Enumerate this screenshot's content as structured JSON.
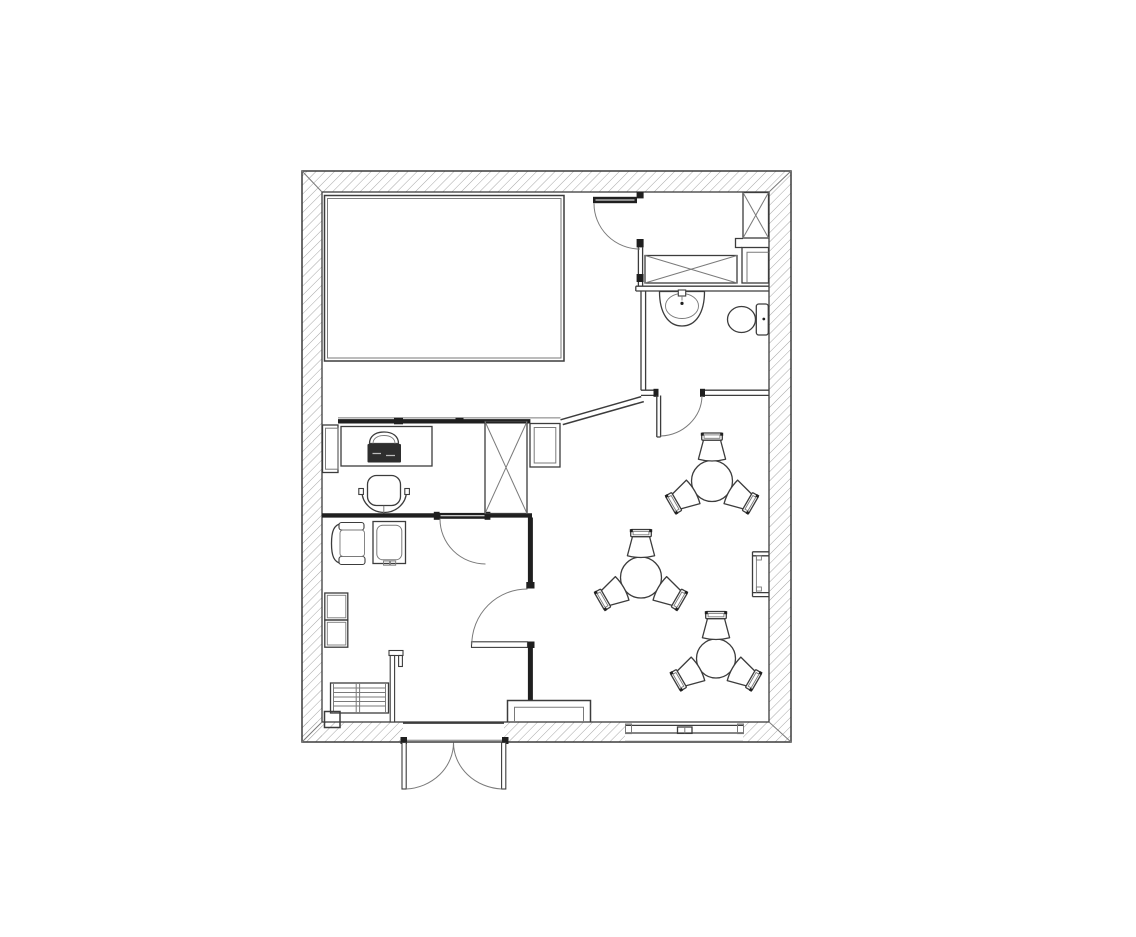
{
  "meta": {
    "title": "Black-and-white architectural floor plan drawing"
  },
  "canvas": {
    "width": 1136,
    "height": 937,
    "background": "#ffffff"
  },
  "palette": {
    "paper": "#ffffff",
    "wall": "#3c3c3c",
    "light": "#7a7a7a",
    "dark": "#1f1f1f",
    "hatch": "#9c9c9c",
    "furniture_dark": "#2e2e2e"
  },
  "floorplan": {
    "exterior": {
      "outer": {
        "x": 302,
        "y": 171,
        "w": 489,
        "h": 571
      },
      "inner": {
        "x": 322,
        "y": 192,
        "w": 447,
        "h": 530
      },
      "openings": [
        {
          "name": "entrance-double-door",
          "wall": "bottom",
          "x1": 403,
          "x2": 504
        },
        {
          "name": "window",
          "wall": "bottom",
          "x1": 625,
          "x2": 743
        }
      ]
    },
    "rooms": [
      {
        "name": "main-room",
        "features": [
          "large-rectangular-platform"
        ]
      },
      {
        "name": "office-nook",
        "features": [
          "desk",
          "desk-chair",
          "laptop",
          "window-sill"
        ]
      },
      {
        "name": "lounge-room",
        "features": [
          "armchair",
          "side-table",
          "wall-shelves",
          "radiator-bench",
          "corner-box",
          "partition-stub"
        ]
      },
      {
        "name": "bathroom",
        "features": [
          "sink",
          "toilet"
        ]
      },
      {
        "name": "utility-room",
        "features": [
          "tall-x-cabinet",
          "low-x-cabinet",
          "corner-duct"
        ]
      },
      {
        "name": "cafe-area",
        "features": [
          "three-round-tables",
          "nine-tub-chairs",
          "wall-radiator",
          "entry-counter"
        ]
      }
    ],
    "cafe_tables": [
      {
        "cx": 712,
        "cy": 481,
        "r": 20.5,
        "chair_distance": 31,
        "chair_angles_deg": [
          270,
          150,
          30
        ]
      },
      {
        "cx": 641,
        "cy": 577.5,
        "r": 20.5,
        "chair_distance": 31,
        "chair_angles_deg": [
          270,
          150,
          30
        ]
      },
      {
        "cx": 716,
        "cy": 658.5,
        "r": 19.5,
        "chair_distance": 30,
        "chair_angles_deg": [
          270,
          150,
          30
        ]
      }
    ],
    "x_marked_fixtures": [
      {
        "name": "utility-tall-cabinet",
        "x": 743,
        "y": 192.5,
        "w": 25.5,
        "h": 45.5
      },
      {
        "name": "utility-low-cabinet",
        "x": 645,
        "y": 255.5,
        "w": 92,
        "h": 27.5
      },
      {
        "name": "office-shaft",
        "x": 485,
        "y": 421.5,
        "w": 42,
        "h": 92
      }
    ],
    "doors": [
      {
        "name": "utility-room-door",
        "hinge": [
          640,
          203
        ],
        "swing": "into-main-room"
      },
      {
        "name": "bathroom-door",
        "hinge": [
          657,
          396
        ],
        "swing": "into-cafe-area"
      },
      {
        "name": "office-door",
        "hinge": [
          486,
          519
        ],
        "swing": "into-lounge-room"
      },
      {
        "name": "lounge-side-door",
        "hinge": [
          527,
          645
        ],
        "swing": "into-lounge-room"
      },
      {
        "name": "entrance-left-leaf",
        "hinge": [
          403,
          743
        ],
        "swing": "outward"
      },
      {
        "name": "entrance-right-leaf",
        "hinge": [
          504,
          743
        ],
        "swing": "outward"
      }
    ]
  }
}
